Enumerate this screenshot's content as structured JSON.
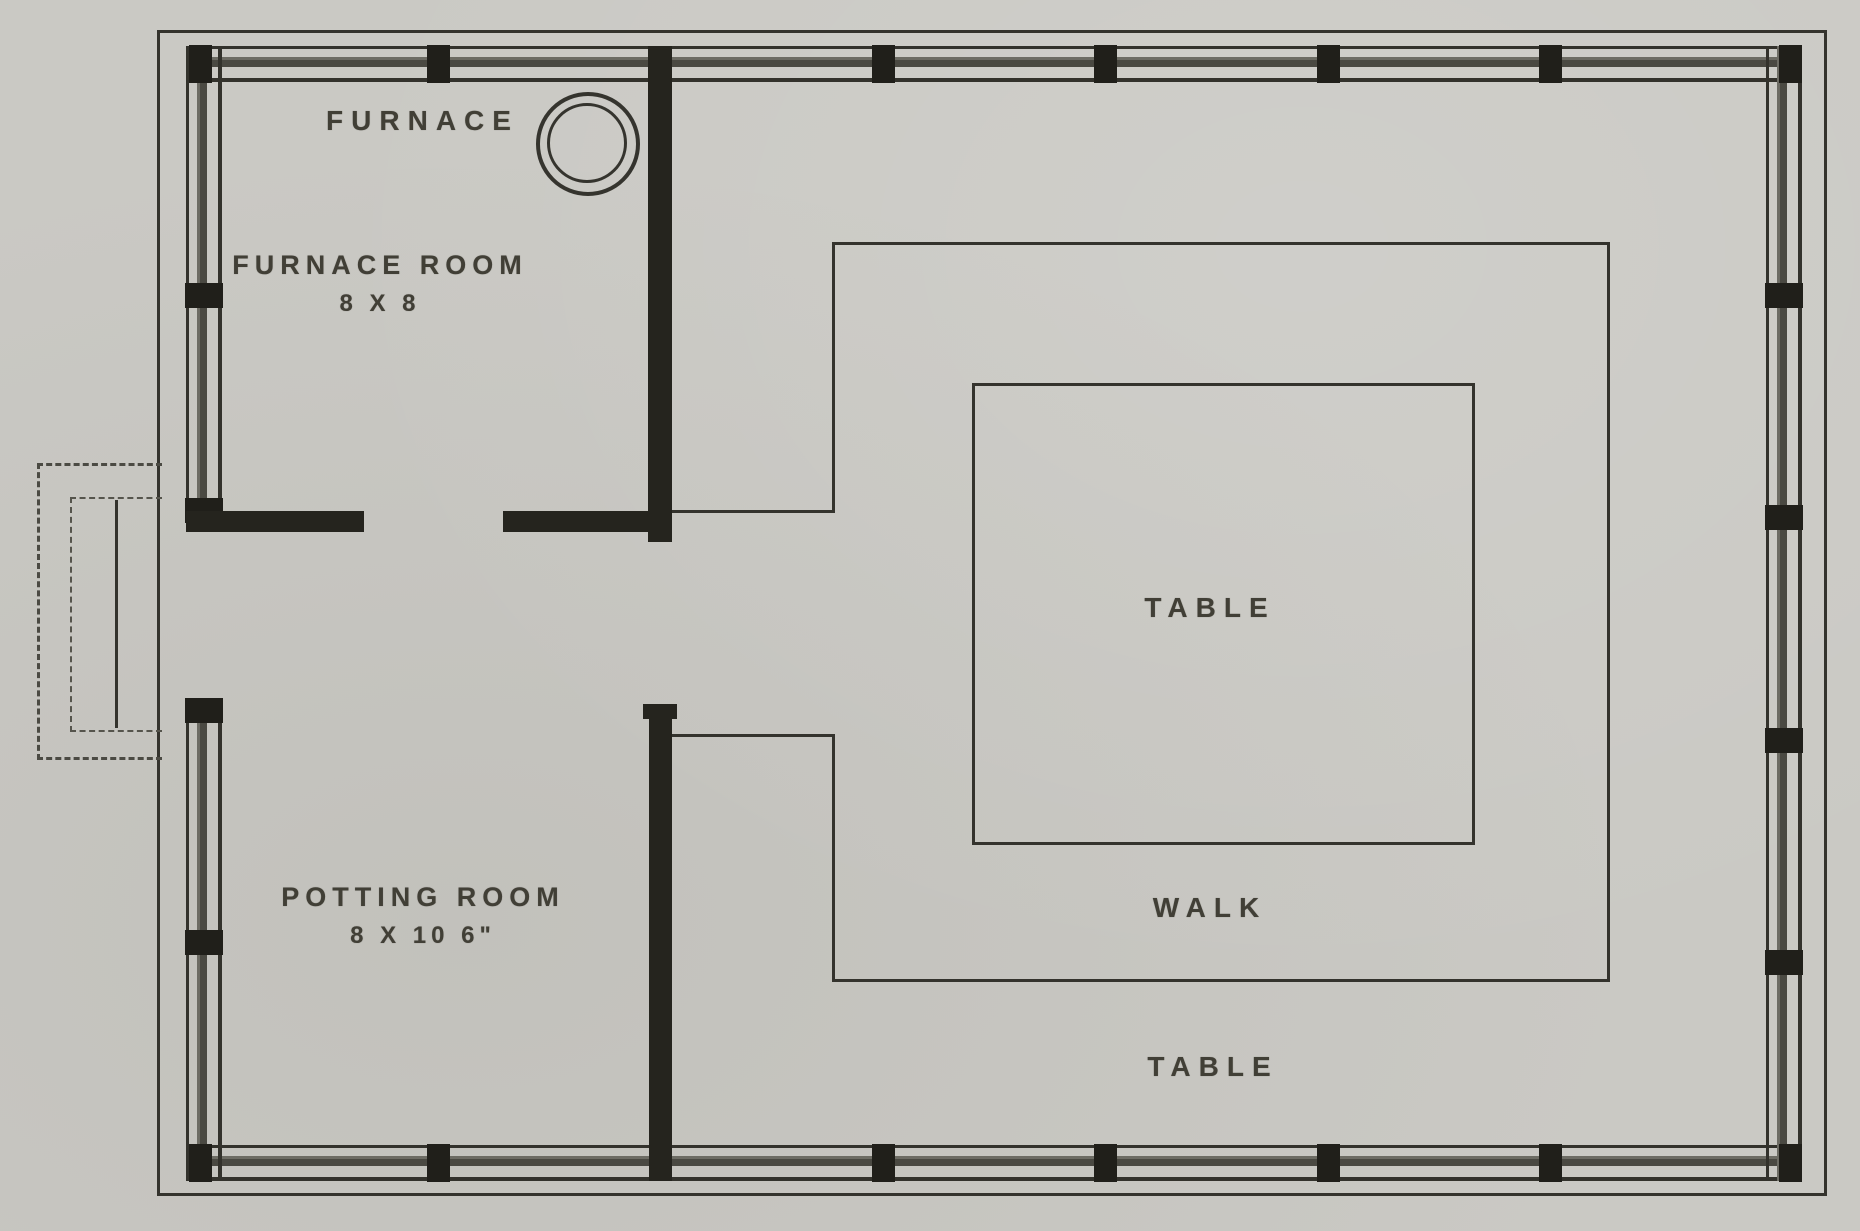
{
  "document": {
    "type": "scanned greenhouse floor plan",
    "paper_color": "#cac9c4",
    "ink_color": "#34332d"
  },
  "labels": {
    "furnace": "FURNACE",
    "furnace_room_name": "FURNACE ROOM",
    "furnace_room_size": "8 X 8",
    "potting_room_name": "POTTING ROOM",
    "potting_room_size": "8 X 10 6\"",
    "table_center": "TABLE",
    "walk": "WALK",
    "table_south": "TABLE"
  },
  "rooms": [
    {
      "name": "FURNACE ROOM",
      "dimensions": "8 X 8"
    },
    {
      "name": "POTTING ROOM",
      "dimensions": "8 X 10 6\""
    }
  ],
  "features": [
    "FURNACE",
    "TABLE",
    "WALK",
    "TABLE"
  ]
}
